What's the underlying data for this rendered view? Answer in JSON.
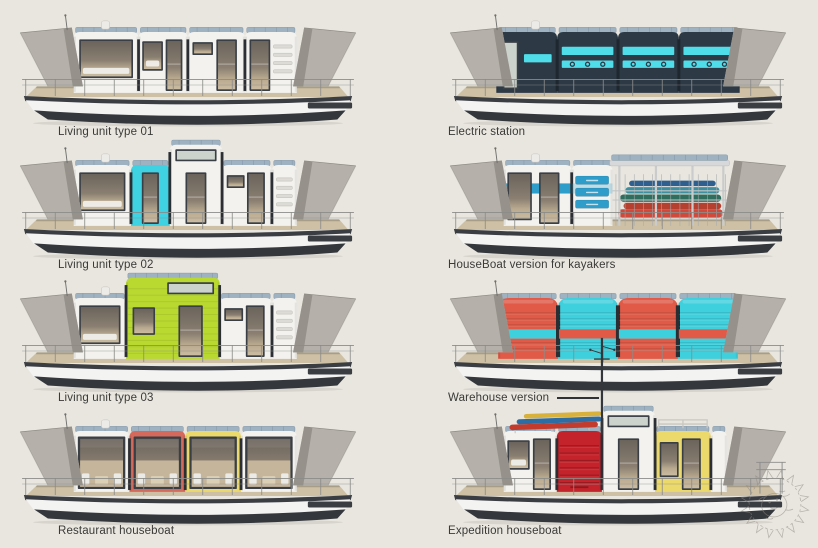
{
  "page": {
    "background": "#e9e6df",
    "caption_color": "#3b3a37"
  },
  "palette": {
    "white": "#f3f2ee",
    "cyan": "#3ed2e2",
    "lime": "#b9d930",
    "salmon": "#d5695b",
    "yellow": "#ecd96c",
    "navy": "#2d3a46",
    "cyanBright": "#4fdde9",
    "contRed": "#e05a47",
    "contCyan": "#3fd0dd",
    "expRed": "#c4232b",
    "blueBand": "#2f9dc9",
    "frame": "#3a3f45",
    "deck": "#cdc0a4",
    "hullDark": "#34373c",
    "hullWhite": "#f3f3f2",
    "wing": "#b5b1aa",
    "wingShade": "#96928b",
    "solar": "#9fb2c1",
    "solarLine": "#7e93a6",
    "rail": "#8b8b89",
    "seam": "#2b2f33",
    "kayakRed": "#d0493a",
    "kayakTeal": "#2f6e5e",
    "ventFill": "#dddbd6",
    "watermark": "#8f8b84"
  },
  "boats": [
    {
      "caption": "Living unit type 01",
      "modules": [
        {
          "type": "window-large",
          "w": 1.25,
          "color": "white"
        },
        {
          "type": "door-window",
          "w": 0.95,
          "color": "white"
        },
        {
          "type": "highwin-door",
          "w": 1.1,
          "color": "white"
        },
        {
          "type": "door-vents",
          "w": 1.0,
          "color": "white"
        }
      ]
    },
    {
      "caption": "Electric station",
      "cab": [
        58,
        322
      ],
      "modules": [
        {
          "type": "navy-door",
          "w": 1,
          "color": "navy"
        },
        {
          "type": "navy-panel",
          "w": 1,
          "color": "navy"
        },
        {
          "type": "navy-panel",
          "w": 1,
          "color": "navy"
        },
        {
          "type": "navy-panel",
          "w": 1,
          "color": "navy"
        }
      ]
    },
    {
      "caption": "Living unit type 02",
      "modules": [
        {
          "type": "window-large",
          "w": 1.15,
          "color": "white"
        },
        {
          "type": "door",
          "w": 0.78,
          "color": "cyan"
        },
        {
          "type": "tall",
          "w": 1.05,
          "color": "white",
          "tall": true
        },
        {
          "type": "highwin-door",
          "w": 1.0,
          "color": "white"
        },
        {
          "type": "vents",
          "w": 0.5,
          "color": "white"
        }
      ]
    },
    {
      "caption": "HouseBoat version for kayakers",
      "modules": [
        {
          "type": "kayak-cabin",
          "w": 1.25,
          "color": "white"
        },
        {
          "type": "drawers",
          "w": 0.75,
          "color": "white"
        },
        {
          "type": "open-bay",
          "w": 2.1
        }
      ]
    },
    {
      "caption": "Living unit type 03",
      "modules": [
        {
          "type": "window-large",
          "w": 0.95,
          "color": "white"
        },
        {
          "type": "lime-tall",
          "w": 1.7,
          "color": "lime",
          "tall": true
        },
        {
          "type": "highwin-door",
          "w": 0.95,
          "color": "white"
        },
        {
          "type": "vents",
          "w": 0.45,
          "color": "white"
        }
      ]
    },
    {
      "caption": "Warehouse version",
      "cab": [
        60,
        320
      ],
      "leader": true,
      "noChimney": true,
      "modules": [
        {
          "type": "container",
          "w": 1,
          "color": "contRed",
          "band": "contCyan"
        },
        {
          "type": "container",
          "w": 1,
          "color": "contCyan",
          "band": "contRed"
        },
        {
          "type": "container",
          "w": 1,
          "color": "contRed",
          "band": "contCyan"
        },
        {
          "type": "container",
          "w": 1,
          "color": "contCyan",
          "band": "contRed"
        }
      ]
    },
    {
      "caption": "Restaurant houseboat",
      "modules": [
        {
          "type": "bigwin",
          "w": 1,
          "color": "white"
        },
        {
          "type": "bigwin",
          "w": 1,
          "color": "salmon"
        },
        {
          "type": "bigwin",
          "w": 1,
          "color": "yellow"
        },
        {
          "type": "bigwin",
          "w": 1,
          "color": "white"
        }
      ]
    },
    {
      "caption": "Expedition houseboat",
      "mast": true,
      "roofKayaks": true,
      "sternRail": true,
      "noChimney": true,
      "modules": [
        {
          "type": "door-window",
          "w": 1.0,
          "color": "white"
        },
        {
          "type": "roller",
          "w": 0.85,
          "color": "expRed"
        },
        {
          "type": "tall",
          "w": 1.0,
          "color": "white",
          "tall": true
        },
        {
          "type": "win-door-rack",
          "w": 1.05,
          "color": "yellow"
        },
        {
          "type": "plain",
          "w": 0.3,
          "color": "white"
        }
      ]
    }
  ]
}
